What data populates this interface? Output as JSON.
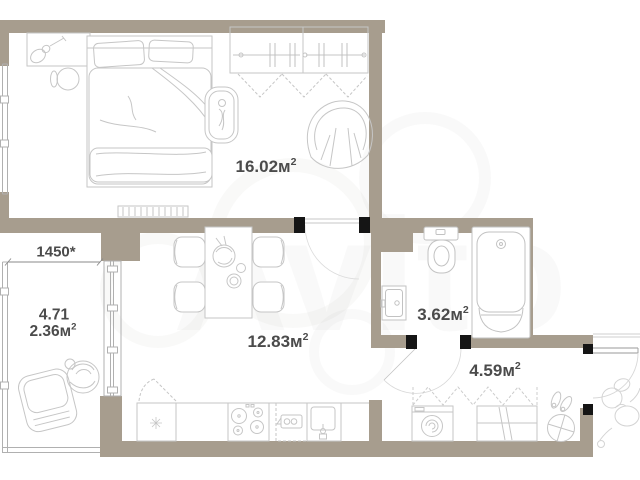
{
  "watermark": {
    "brand": "Avito"
  },
  "rooms": {
    "bedroom": {
      "area": "16.02м",
      "sup": "2"
    },
    "kitchen_living": {
      "area": "12.83м",
      "sup": "2"
    },
    "bathroom": {
      "area": "3.62м",
      "sup": "2"
    },
    "hallway": {
      "area": "4.59м",
      "sup": "2"
    },
    "balcony": {
      "width_dimension": "1450*",
      "area_total": "4.71",
      "area_reduced": "2.36м",
      "sup": "2"
    }
  },
  "colors": {
    "wall": "#a79d8e",
    "door_jamb": "#151515",
    "furniture_line": "#c6c6c6",
    "window_line": "#b0b0b0",
    "label_text": "#4b4b4b",
    "background": "#ffffff"
  }
}
